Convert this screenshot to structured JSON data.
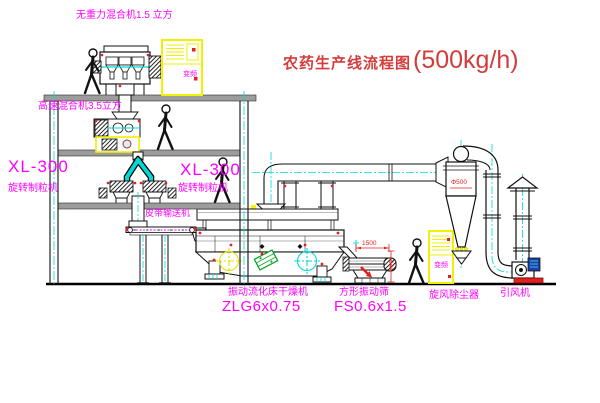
{
  "title": {
    "text_cn": "农药生产线流程图",
    "capacity": "(500kg/h)"
  },
  "equipment_labels": {
    "gravity_free_mixer": "无重力混合机1.5 立方",
    "high_speed_mixer": "高速混合机3.5立方",
    "granulator_left": {
      "model": "XL-300",
      "name": "旋转制粒机"
    },
    "granulator_right": {
      "model": "XL-300",
      "name": "旋转制粒机"
    },
    "belt_conveyor": "皮带输送机",
    "fluid_bed_dryer": {
      "name": "振动流化床干燥机",
      "model": "ZLG6x0.75"
    },
    "square_vibrating_screen": {
      "name": "方形振动筛",
      "model": "FS0.6x1.5"
    },
    "cyclone_dust_collector": "旋风除尘器",
    "induced_draft_fan": "引风机",
    "control_cabinet": "变频"
  },
  "dimensions": {
    "cyclone_diameter": "Φ500",
    "screen_length": "1500",
    "screen_height": "941"
  },
  "colors": {
    "label_magenta": "#ff00ff",
    "title_red": "#d43c3c",
    "dimension_red": "#e02020",
    "centerline_cyan": "#00d8d8",
    "cabinet_yellow": "#f0f000"
  }
}
